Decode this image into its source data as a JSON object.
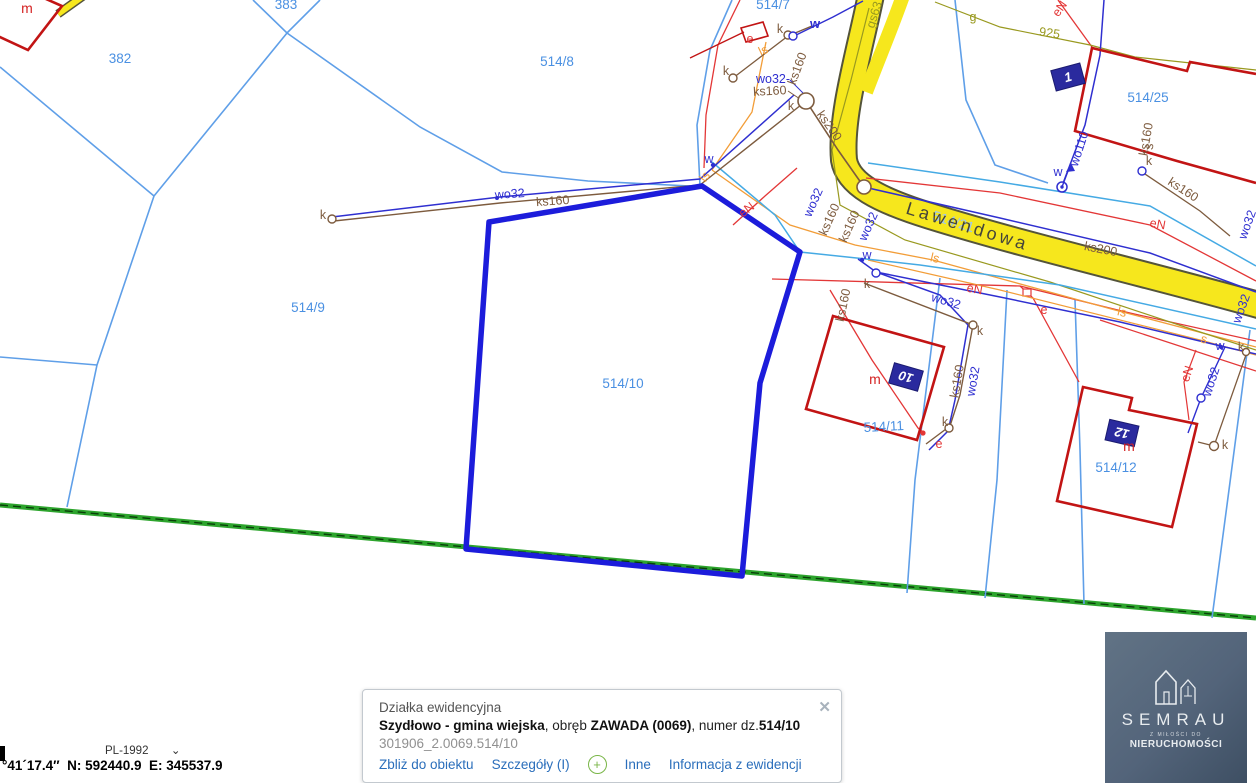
{
  "colors": {
    "parcel-line": "#5f9fe8",
    "selection": "#1c1cdb",
    "green-road": "#2da42d",
    "green-dash": "#093f09",
    "road-fill": "#f6e71d",
    "road-casing": "#54543a",
    "building-red": "#c21414",
    "utility-red": "#e33737",
    "utility-indigo": "#2f2fd0",
    "utility-cyan": "#45aae4",
    "utility-brown": "#7d5b3e",
    "utility-orange": "#f29d38",
    "utility-olive": "#99991f",
    "plate-navy": "#2a2a9e",
    "parcel-label": "#4a90e2",
    "link-blue": "#2a6ebb"
  },
  "map": {
    "labels": [
      {
        "t": "382",
        "x": 120,
        "y": 63,
        "r": 0,
        "c": "parcel"
      },
      {
        "t": "383",
        "x": 286,
        "y": 9,
        "r": 0,
        "c": "parcel"
      },
      {
        "t": "514/8",
        "x": 557,
        "y": 66,
        "r": 0,
        "c": "parcel"
      },
      {
        "t": "514/7",
        "x": 773,
        "y": 9,
        "r": 0,
        "c": "parcel"
      },
      {
        "t": "514/9",
        "x": 308,
        "y": 312,
        "r": 0,
        "c": "parcel"
      },
      {
        "t": "514/10",
        "x": 623,
        "y": 388,
        "r": 0,
        "c": "parcel"
      },
      {
        "t": "514/11",
        "x": 884,
        "y": 431,
        "r": -3,
        "c": "parcel"
      },
      {
        "t": "514/12",
        "x": 1116,
        "y": 472,
        "r": 0,
        "c": "parcel"
      },
      {
        "t": "514/25",
        "x": 1148,
        "y": 102,
        "r": 0,
        "c": "parcel"
      },
      {
        "t": "514/21",
        "x": 952,
        "y": 226,
        "r": 17,
        "c": "parcel-light"
      },
      {
        "t": "Lawendowa",
        "x": 966,
        "y": 232,
        "r": 17,
        "c": "street"
      },
      {
        "t": "wo32",
        "x": 510,
        "y": 198,
        "r": -4,
        "c": "blue"
      },
      {
        "t": "ks160",
        "x": 553,
        "y": 205,
        "r": -4,
        "c": "brown"
      },
      {
        "t": "wo32-",
        "x": 773,
        "y": 83,
        "r": 0,
        "c": "blue"
      },
      {
        "t": "ks160",
        "x": 770,
        "y": 95,
        "r": -3,
        "c": "brown"
      },
      {
        "t": "ks160",
        "x": 801,
        "y": 70,
        "r": -70,
        "c": "brown"
      },
      {
        "t": "k",
        "x": 791,
        "y": 110,
        "r": 0,
        "c": "brown"
      },
      {
        "t": "ks200",
        "x": 826,
        "y": 128,
        "r": 55,
        "c": "brown"
      },
      {
        "t": "k",
        "x": 780,
        "y": 33,
        "r": 0,
        "c": "brown"
      },
      {
        "t": "w",
        "x": 815,
        "y": 28,
        "r": 0,
        "c": "blue-b"
      },
      {
        "t": "e",
        "x": 750,
        "y": 43,
        "r": 0,
        "c": "red"
      },
      {
        "t": "ls",
        "x": 765,
        "y": 54,
        "r": -25,
        "c": "orange"
      },
      {
        "t": "k",
        "x": 726,
        "y": 75,
        "r": 0,
        "c": "brown"
      },
      {
        "t": "wo110",
        "x": 1083,
        "y": 150,
        "r": -72,
        "c": "blue"
      },
      {
        "t": "w",
        "x": 1058,
        "y": 176,
        "r": 0,
        "c": "blue"
      },
      {
        "t": "gs63",
        "x": 878,
        "y": 16,
        "r": -72,
        "c": "olive"
      },
      {
        "t": "g",
        "x": 973,
        "y": 21,
        "r": 0,
        "c": "olive"
      },
      {
        "t": "925",
        "x": 1049,
        "y": 37,
        "r": 8,
        "c": "olive"
      },
      {
        "t": "eN",
        "x": 1063,
        "y": 11,
        "r": -55,
        "c": "red"
      },
      {
        "t": "ks160",
        "x": 1150,
        "y": 140,
        "r": -80,
        "c": "brown"
      },
      {
        "t": "k",
        "x": 1149,
        "y": 165,
        "r": 0,
        "c": "brown"
      },
      {
        "t": "s",
        "x": 1153,
        "y": 147,
        "r": -80,
        "c": "brown"
      },
      {
        "t": "ks160",
        "x": 1181,
        "y": 193,
        "r": 33,
        "c": "brown"
      },
      {
        "t": "eN",
        "x": 1157,
        "y": 228,
        "r": 10,
        "c": "red"
      },
      {
        "t": "ks200",
        "x": 1100,
        "y": 253,
        "r": 11,
        "c": "brown"
      },
      {
        "t": "wo32",
        "x": 1251,
        "y": 226,
        "r": -70,
        "c": "blue"
      },
      {
        "t": "ls",
        "x": 934,
        "y": 262,
        "r": 13,
        "c": "orange"
      },
      {
        "t": "ls",
        "x": 1121,
        "y": 316,
        "r": 14,
        "c": "orange"
      },
      {
        "t": "s",
        "x": 1203,
        "y": 343,
        "r": 14,
        "c": "orange"
      },
      {
        "t": "wo32",
        "x": 945,
        "y": 305,
        "r": 16,
        "c": "blue"
      },
      {
        "t": "eN",
        "x": 974,
        "y": 293,
        "r": 10,
        "c": "red"
      },
      {
        "t": "w",
        "x": 867,
        "y": 259,
        "r": 0,
        "c": "blue"
      },
      {
        "t": "w",
        "x": 1220,
        "y": 350,
        "r": 0,
        "c": "blue"
      },
      {
        "t": "k",
        "x": 1241,
        "y": 351,
        "r": 0,
        "c": "brown"
      },
      {
        "t": "wo32",
        "x": 1245,
        "y": 310,
        "r": -70,
        "c": "blue"
      },
      {
        "t": "eN",
        "x": 1191,
        "y": 375,
        "r": -72,
        "c": "red"
      },
      {
        "t": "wo32",
        "x": 1215,
        "y": 383,
        "r": -72,
        "c": "blue"
      },
      {
        "t": "k",
        "x": 1225,
        "y": 449,
        "r": 0,
        "c": "brown"
      },
      {
        "t": "k",
        "x": 867,
        "y": 288,
        "r": 0,
        "c": "brown"
      },
      {
        "t": "k",
        "x": 980,
        "y": 335,
        "r": 0,
        "c": "brown"
      },
      {
        "t": "ks160",
        "x": 961,
        "y": 382,
        "r": -80,
        "c": "brown"
      },
      {
        "t": "wo32",
        "x": 977,
        "y": 382,
        "r": -80,
        "c": "blue"
      },
      {
        "t": "k",
        "x": 945,
        "y": 426,
        "r": 0,
        "c": "brown"
      },
      {
        "t": "e",
        "x": 939,
        "y": 448,
        "r": 0,
        "c": "red"
      },
      {
        "t": "e",
        "x": 1044,
        "y": 314,
        "r": 0,
        "c": "red"
      },
      {
        "t": "m",
        "x": 875,
        "y": 384,
        "r": 0,
        "c": "m"
      },
      {
        "t": "m",
        "x": 1129,
        "y": 451,
        "r": 0,
        "c": "m"
      },
      {
        "t": "m",
        "x": 27,
        "y": 13,
        "r": 0,
        "c": "m"
      },
      {
        "t": "k",
        "x": 323,
        "y": 219,
        "r": 0,
        "c": "brown"
      },
      {
        "t": "wo32",
        "x": 817,
        "y": 204,
        "r": -66,
        "c": "blue"
      },
      {
        "t": "ks160",
        "x": 833,
        "y": 221,
        "r": -66,
        "c": "brown"
      },
      {
        "t": "ks160",
        "x": 853,
        "y": 228,
        "r": -66,
        "c": "brown"
      },
      {
        "t": "wo32",
        "x": 872,
        "y": 228,
        "r": -66,
        "c": "blue"
      },
      {
        "t": "eN",
        "x": 749,
        "y": 213,
        "r": -38,
        "c": "red"
      },
      {
        "t": "ls",
        "x": 708,
        "y": 179,
        "r": -55,
        "c": "orange"
      },
      {
        "t": "w",
        "x": 709,
        "y": 163,
        "r": 0,
        "c": "blue"
      },
      {
        "t": "ks160",
        "x": 847,
        "y": 306,
        "r": -78,
        "c": "brown"
      }
    ],
    "plates": [
      {
        "t": "1",
        "x": 1068,
        "y": 77,
        "r": -15
      },
      {
        "t": "10",
        "x": 906,
        "y": 377,
        "r": 196
      },
      {
        "t": "12",
        "x": 1122,
        "y": 433,
        "r": 193
      }
    ]
  },
  "popup": {
    "title": "Działka ewidencyjna",
    "muni": "Szydłowo - gmina wiejska",
    "sep1": ", obręb ",
    "obreb": "ZAWADA (0069)",
    "sep2": ", numer dz.",
    "parcel": "514/10",
    "ident": "301906_2.0069.514/10",
    "links": [
      "Zbliż do obiektu",
      "Szczegóły (I)",
      "Inne",
      "Informacja z ewidencji"
    ],
    "plus_icon": "+",
    "close_icon": "✕"
  },
  "statusbar": {
    "crs": "PL-1992",
    "chevron": "⌄",
    "coords": "°41´17.4″  N: 592440.9  E: 345537.9"
  },
  "logo": {
    "brand": "SEMRAU",
    "tag1": "Z MIŁOŚCI DO",
    "tag2": "NIERUCHOMOŚCI"
  }
}
